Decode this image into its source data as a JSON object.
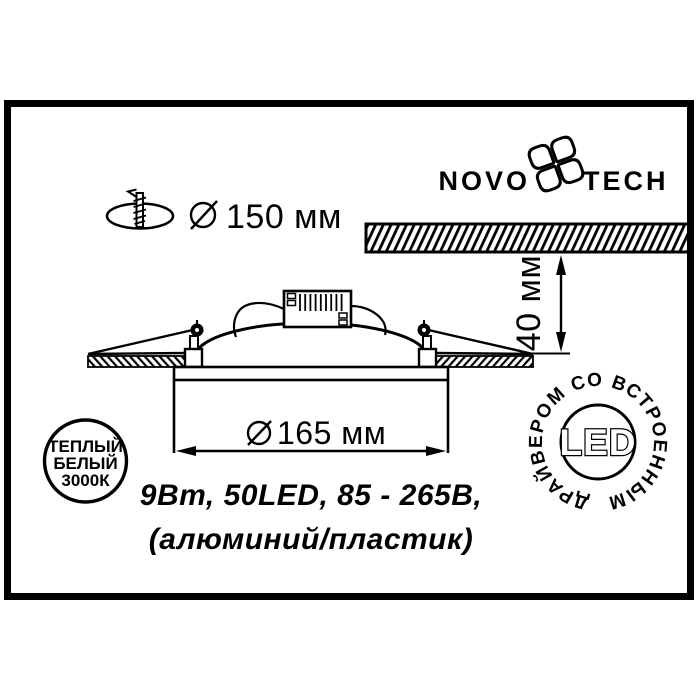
{
  "colors": {
    "ink": "#000000",
    "paper": "#ffffff"
  },
  "brand": {
    "word_left": "NOVO",
    "word_right": "TECH"
  },
  "dimensions": {
    "cutout_diameter": "150 мм",
    "recess_depth": "40 мм",
    "fixture_diameter": "165 мм"
  },
  "specs": {
    "line1": "9Вт, 50LED, 85 - 265В,",
    "line2": "(алюминий/пластик)"
  },
  "badges": {
    "warm_white": {
      "line1": "ТЕПЛЫЙ",
      "line2": "БЕЛЫЙ",
      "line3": "3000К"
    },
    "led": {
      "center_label": "LED",
      "ring_label": "ДРАЙВЕРОМ СО ВСТРОЕННЫМ"
    }
  }
}
